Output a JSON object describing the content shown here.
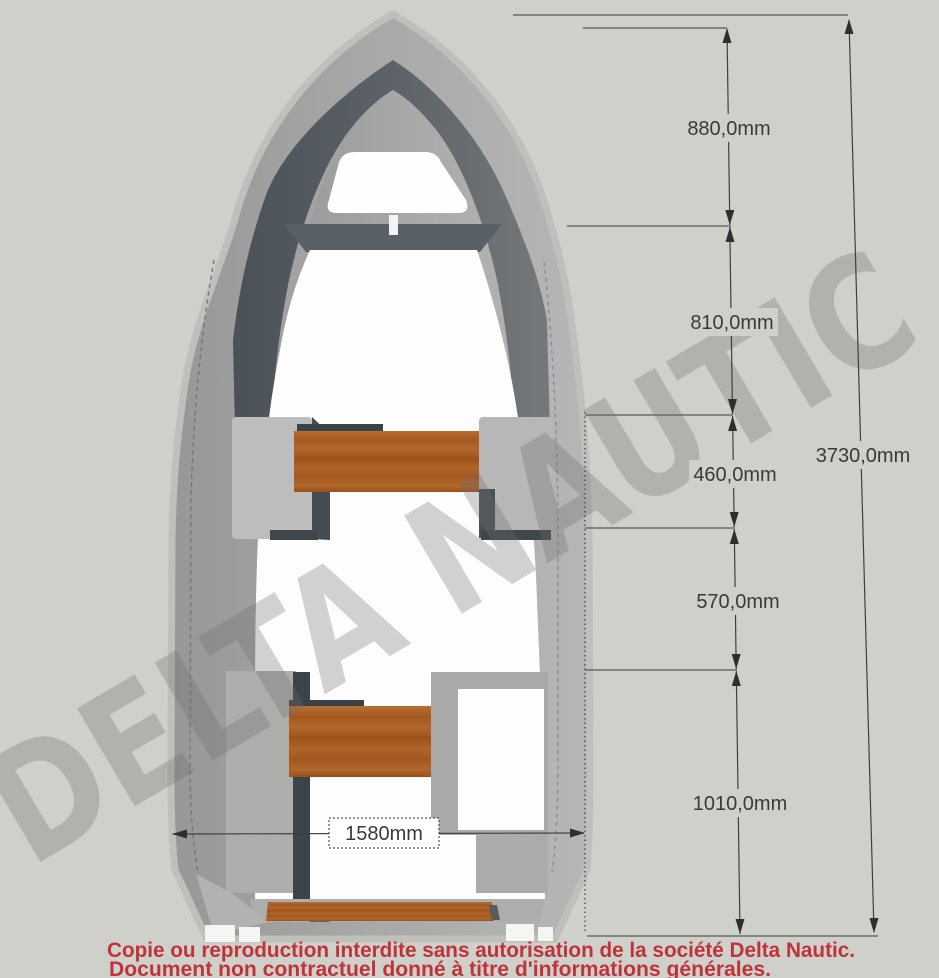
{
  "watermark": {
    "text": "DELTA NAUTIC"
  },
  "dimensions": {
    "d880": "880,0mm",
    "d810": "810,0mm",
    "d460": "460,0mm",
    "d570": "570,0mm",
    "d1010": "1010,0mm",
    "d3730": "3730,0mm",
    "d1580": "1580mm"
  },
  "footer": {
    "line1": "Copie ou reproduction interdite sans autorisation de la société Delta Nautic.",
    "line2": "Document non contractuel donné à titre d'informations générales."
  },
  "colors": {
    "background": "#D0D0CA",
    "hull_gray": "#A6A6A6",
    "gunwale_dark": "#565C62",
    "wood": "#AC6026",
    "cockpit_white": "#FDFDFD",
    "dimension_text": "#3A3A3A",
    "footer_red": "#BF333A",
    "watermark_gray": "#8F8F8B"
  }
}
